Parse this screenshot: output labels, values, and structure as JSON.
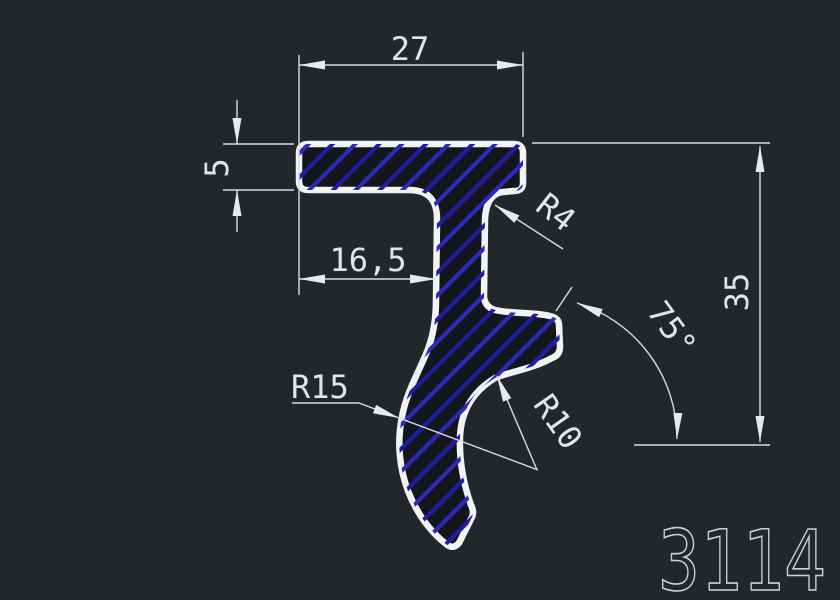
{
  "part_number": "3114",
  "dimensions": {
    "top_width": "27",
    "flange_thickness": "5",
    "web_offset": "16,5",
    "fillet_radius": "R4",
    "overall_height": "35",
    "angle": "75°",
    "outer_radius": "R15",
    "inner_radius": "R10"
  },
  "colors": {
    "background": "#23272c",
    "profile_outline": "#f2f3f5",
    "hatch_blue_dark": "#1e1ea2",
    "hatch_blue_bright": "#2a2abc",
    "dimension_lines": "#d9dde2",
    "part_number_text": "#cdd2d8"
  }
}
